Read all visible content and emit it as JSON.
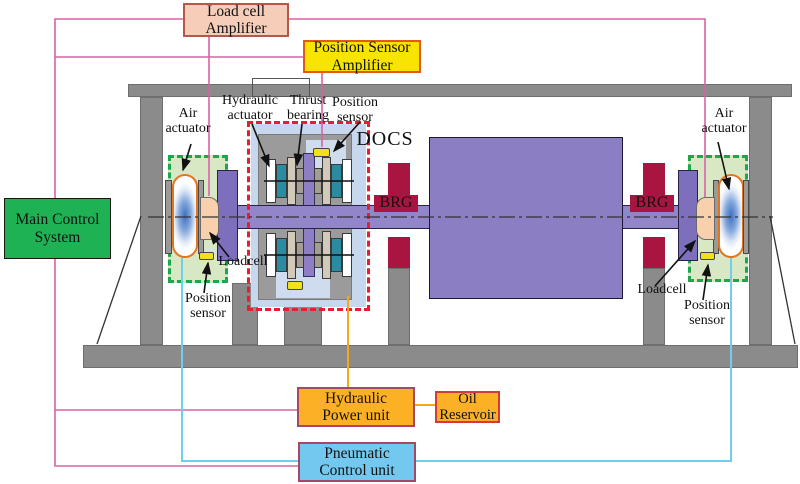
{
  "boxes": {
    "load_cell_amplifier": {
      "line1": "Load cell",
      "line2": "Amplifier"
    },
    "position_sensor_amplifier": {
      "line1": "Position Sensor",
      "line2": "Amplifier"
    },
    "main_control_system": {
      "line1": "Main Control",
      "line2": "System"
    },
    "hydraulic_power_unit": {
      "line1": "Hydraulic",
      "line2": "Power unit"
    },
    "oil_reservoir": {
      "line1": "Oil",
      "line2": "Reservoir"
    },
    "pneumatic_control_unit": {
      "line1": "Pneumatic",
      "line2": "Control unit"
    }
  },
  "labels": {
    "air_actuator_left": {
      "line1": "Air",
      "line2": "actuator"
    },
    "air_actuator_right": {
      "line1": "Air",
      "line2": "actuator"
    },
    "hydraulic_actuator": {
      "line1": "Hydraulic",
      "line2": "actuator"
    },
    "thrust_bearing": {
      "line1": "Thrust",
      "line2": "bearing"
    },
    "position_sensor_docs": {
      "line1": "Position",
      "line2": "sensor"
    },
    "position_sensor_left": {
      "line1": "Position",
      "line2": "sensor"
    },
    "position_sensor_right": {
      "line1": "Position",
      "line2": "sensor"
    },
    "loadcell_left": "Loadcell",
    "loadcell_right": "Loadcell",
    "docs": "DOCS",
    "brg_left": "BRG",
    "brg_right": "BRG"
  },
  "colors": {
    "wire-pink": "#d862a6",
    "wire-cyan": "#6fcdf0",
    "wire-orange": "#f6a81c",
    "frame-gray": "#8b8b8b",
    "docs-gray": "#9b9b9b",
    "docs-blue": "#c7d8ee",
    "pocket-blue": "#cfdcf0",
    "purple-shaft": "#9285c9",
    "purple-rotor": "#8b7ec3",
    "purple-disk": "#7e6fbc",
    "purple-rod": "#8e7ec6",
    "crimson": "#a81540",
    "green-zone": "#d9e8c4",
    "green-dash": "#1aa84c",
    "red-dash": "#ea1c2d",
    "chip-yellow": "#f3e01c",
    "peach": "#f8d0ae",
    "capsule-orange": "#e0761f",
    "teal-plate": "#2b8ba1",
    "tan-plate": "#d2c9b8",
    "gray-plate": "#a49d94",
    "gray-plate2": "#9a9a9a",
    "lca-fill": "#f5cdb8",
    "lca-border": "#b5574a",
    "psa-fill": "#f7e400",
    "psa-border": "#e4581a",
    "mcs-fill": "#1fb254",
    "amber-fill": "#fbb025",
    "maroon-border": "#a4486a",
    "oil-border": "#d53a3a",
    "pcu-fill": "#72c8ee"
  }
}
